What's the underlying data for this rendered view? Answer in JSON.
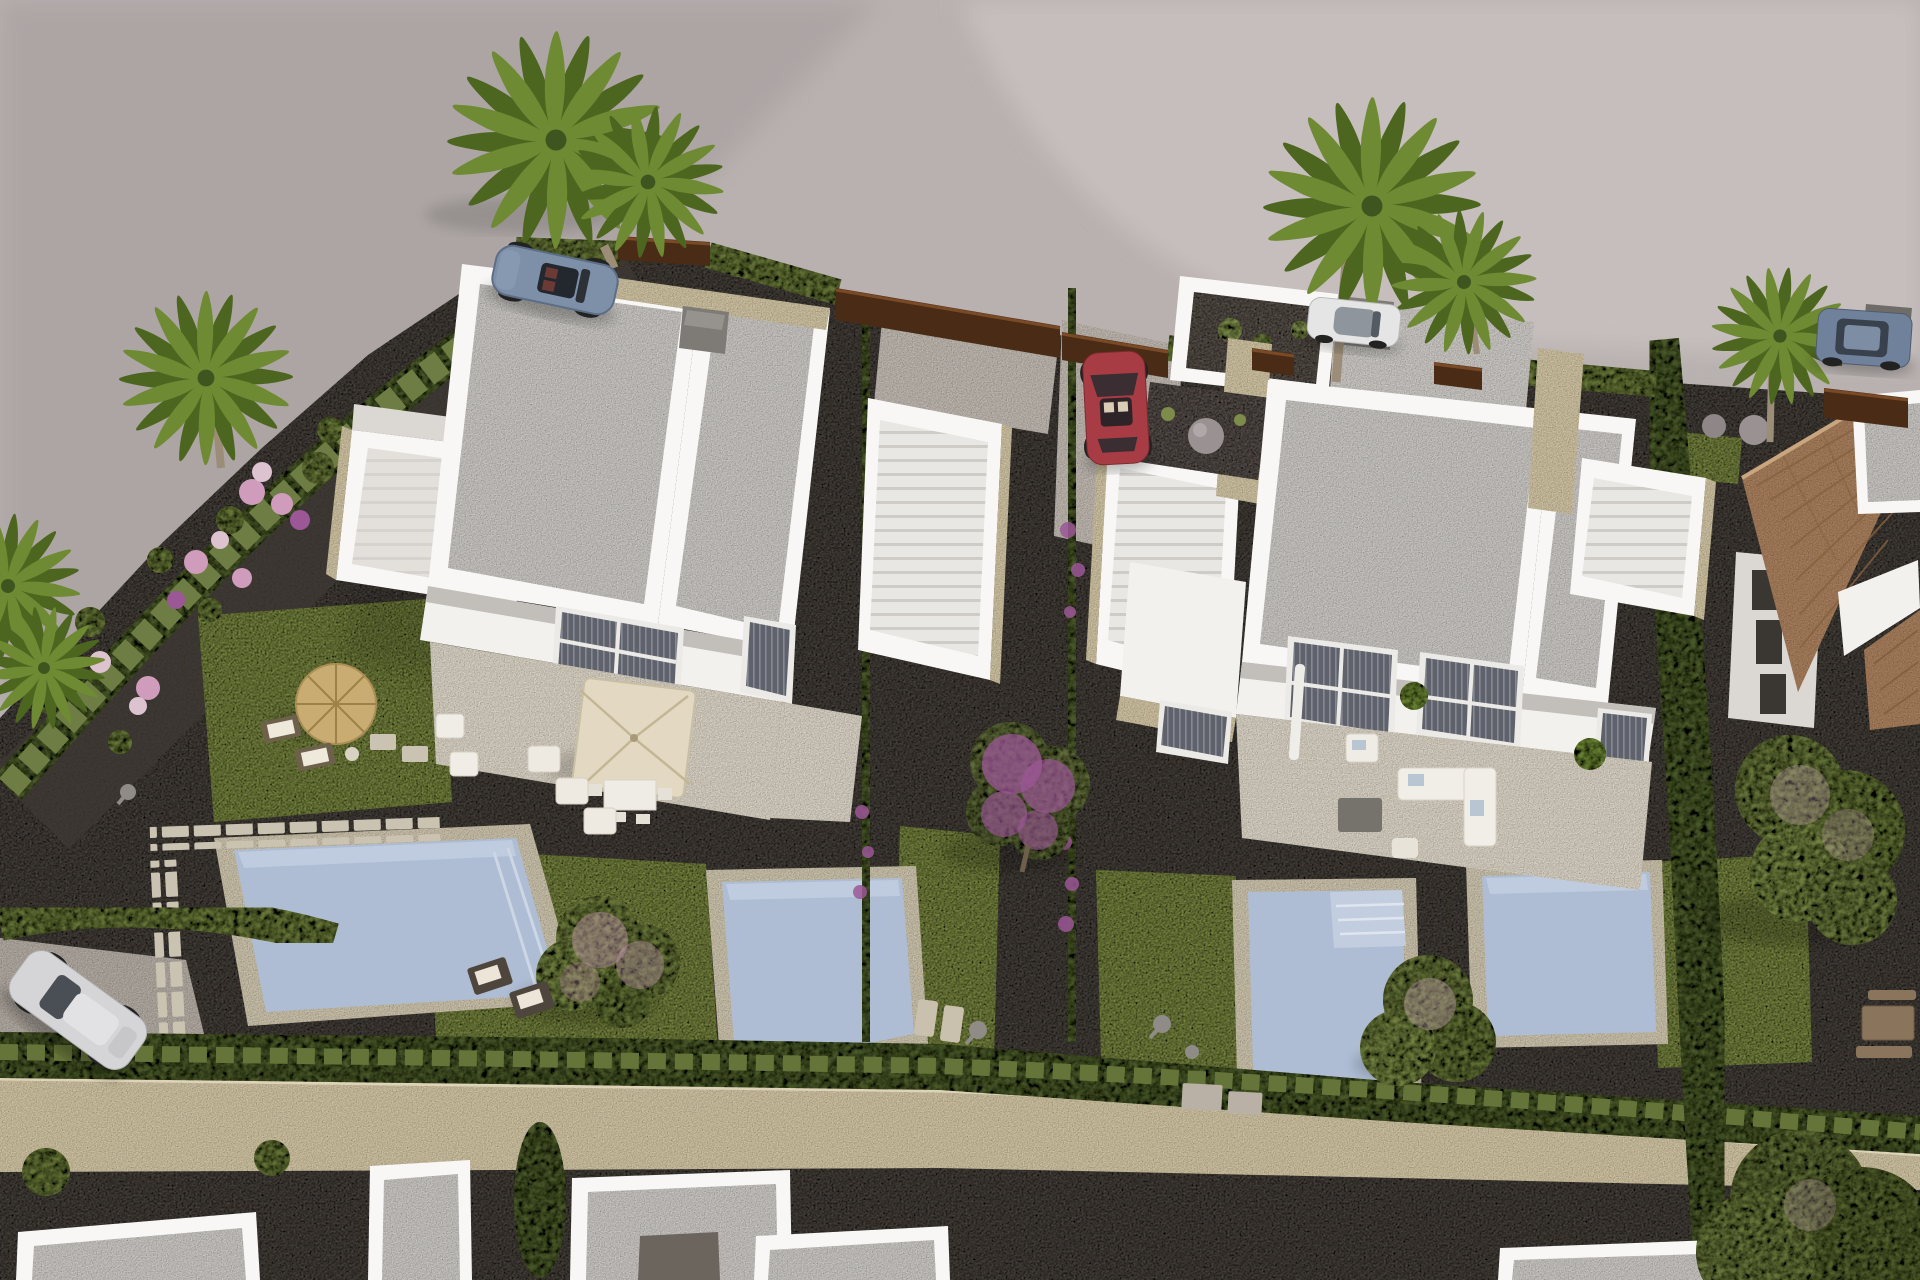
{
  "scene": {
    "kind": "aerial-3d-architectural-render",
    "description": "Bird's-eye render of a new residential development: two modern white semi-detached villas with flat speckled roofs, roof-terrace stairs, private pools and landscaped gardens, bounded by hedges and a stone wall, with a curving grey road, parked cars, palm trees and an existing terracotta-roof house on the right."
  },
  "counts": {
    "villas": 2,
    "villa_units": 4,
    "swimming_pools": 4,
    "vehicles": 5,
    "palm_trees": 8,
    "parasols": 3,
    "neighboring_flat_roof_buildings": 6
  },
  "vehicles": [
    {
      "name": "sports-car",
      "color_key": "car_blue",
      "location": "road top-left"
    },
    {
      "name": "white-sedan",
      "color_key": "car_white",
      "location": "road top-center-right"
    },
    {
      "name": "suv",
      "color_key": "car_suv",
      "location": "road top-right"
    },
    {
      "name": "silver-suv",
      "color_key": "car_silver",
      "location": "parking bottom-left"
    },
    {
      "name": "red-compact",
      "color_key": "car_red",
      "location": "central driveway"
    }
  ],
  "buildings": [
    {
      "name": "left-villa",
      "style": "modern white, two flat roof panels, stone accents, roof terrace"
    },
    {
      "name": "right-villa",
      "style": "modern white, two flat roof panels, stone accents, roof terrace"
    },
    {
      "name": "tiled-roof-house",
      "style": "existing house with terracotta barrel-tile hip roof"
    },
    {
      "name": "neighbor-flat-roofs",
      "style": "white parapet flat-roof houses along bottom edge"
    }
  ],
  "landscape": {
    "ground": [
      "grey asphalt road",
      "dark gravel planting beds",
      "lawn patches",
      "light stone terraces",
      "stepping-stone path"
    ],
    "plants": [
      "cypress hedges",
      "boxwood hedge rows",
      "fan palms",
      "bougainvillea with purple bloom",
      "pink blossom trees",
      "flower bushes pink purple white",
      "lavender planters"
    ],
    "features": [
      "four light-blue pools with tan decks",
      "straw parasol with loungers",
      "square cream parasol with dining set",
      "white outdoor sofas",
      "stone boundary wall",
      "corten fence panels",
      "garden lamps",
      "boulders"
    ]
  },
  "palette": {
    "road": "#b8b1b0",
    "road_light": "#cdc6c4",
    "road_shadow": "#9d9595",
    "curb": "#d4cdc9",
    "gravel_dark": "#45403a",
    "gravel_mid": "#5b554e",
    "pad_light": "#bfb8b0",
    "grass": "#75823f",
    "grass_dark": "#5a682f",
    "hedge": "#657539",
    "hedge_dark": "#49582b",
    "hedge_light": "#7d8c4b",
    "stone": "#cfc2a2",
    "stone_light": "#ddd2b6",
    "wall_white": "#f3f1ee",
    "wall_shade": "#dbd8d4",
    "parapet": "#f8f7f5",
    "roof": "#c9c6c2",
    "roof_shade": "#b5b2ae",
    "terrace": "#d9d2c4",
    "window_glass": "#585a62",
    "window_frame": "#eceae7",
    "pool_water": "#aebdd4",
    "pool_light": "#c6d1e2",
    "pool_deck": "#cbc2ab",
    "tile_roof": "#a87f5d",
    "tile_dark": "#86613f",
    "wood": "#8a745c",
    "straw": "#c9ac72",
    "cream": "#e3d9c2",
    "car_blue": "#7e90a8",
    "car_red": "#a83c44",
    "car_white": "#e6e5e6",
    "car_silver": "#d5d4d6",
    "car_suv": "#70829b",
    "wheel": "#2e2d2f",
    "purple": "#9b5796",
    "pink": "#cf9dbb",
    "palm": "#6b8434",
    "palm_dark": "#4f6825",
    "trunk": "#9b8d77",
    "box_gray": "#7e7b76",
    "corten": "#4a2c16"
  }
}
